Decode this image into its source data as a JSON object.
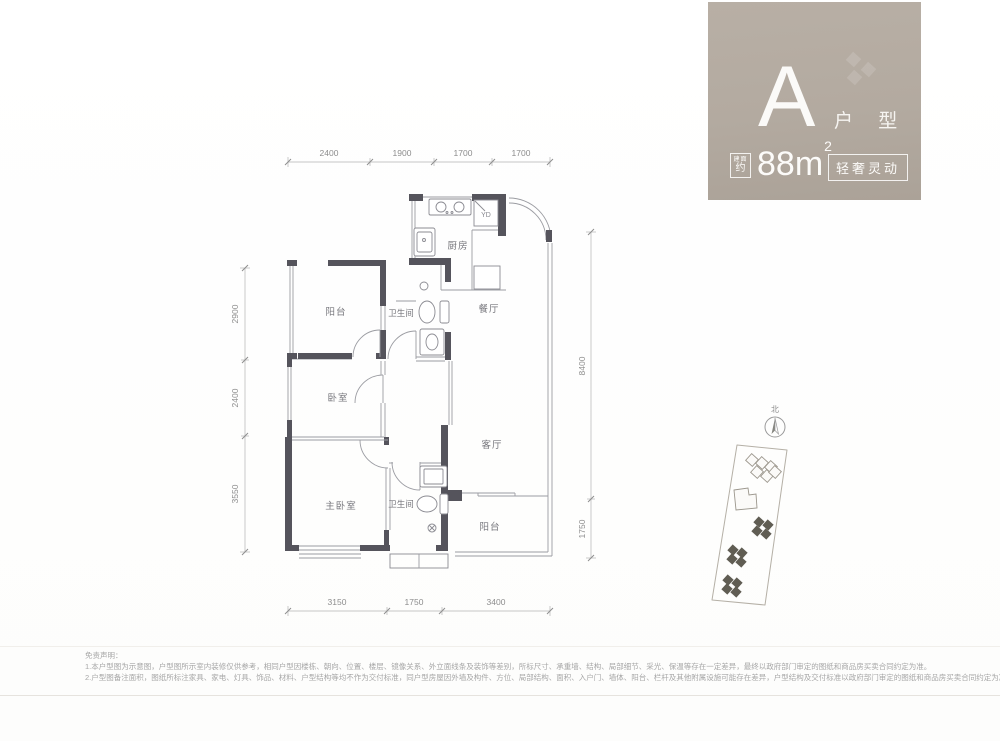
{
  "header": {
    "type_letter": "A",
    "type_label": "户 型",
    "area_badge_line1": "建面",
    "area_badge_line2": "约",
    "area_value": "88m",
    "area_unit_sup": "2",
    "tagline": "轻奢灵动"
  },
  "floorplan": {
    "rooms": {
      "kitchen": "厨房",
      "dining": "餐厅",
      "balcony_north": "阳台",
      "bath_1": "卫生间",
      "bedroom": "卧室",
      "master_bedroom": "主卧室",
      "bath_2": "卫生间",
      "living": "客厅",
      "balcony_south": "阳台"
    },
    "flue_label": "YD",
    "dimensions": {
      "top": [
        "2400",
        "1900",
        "1700",
        "1700"
      ],
      "left": [
        "2900",
        "2400",
        "3550"
      ],
      "right": [
        "8400",
        "1750"
      ],
      "bottom": [
        "3150",
        "1750",
        "3400"
      ]
    }
  },
  "siteplan": {
    "north_label": "北"
  },
  "disclaimer": {
    "title": "免责声明：",
    "line1": "1.本户型图为示意图，户型图所示室内装修仅供参考，相同户型因楼栋、朝向、位置、楼层、镜像关系、外立面线条及装饰等差别，所标尺寸、承重墙、结构、局部细节、采光、保温等存在一定差异，最终以政府部门审定的图纸和商品房买卖合同约定为准。",
    "line2": "2.户型图备注面积，图纸所标注家具、家电、灯具、饰品、材料、户型结构等均不作为交付标准，同户型房屋因外墙及构件、方位、局部结构、面积、入户门、墙体、阳台、栏杆及其他附属设施可能存在差异，户型结构及交付标准以政府部门审定的图纸和商品房买卖合同约定为准。"
  },
  "colors": {
    "panel": "#b3aaa0",
    "wall": "#55545c",
    "building_highlight": "#605d53"
  }
}
